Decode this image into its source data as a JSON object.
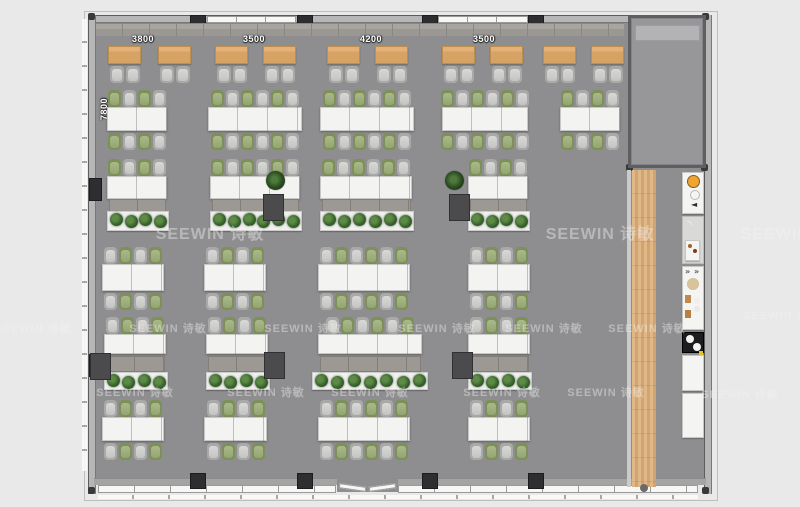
{
  "meta": {
    "description_label": "office floor plan rendering"
  },
  "watermark": {
    "text": "SEEWIN 诗敏",
    "large": [
      [
        210,
        232
      ],
      [
        600,
        232
      ],
      [
        795,
        232
      ]
    ],
    "small": [
      [
        33,
        328
      ],
      [
        168,
        328
      ],
      [
        303,
        328
      ],
      [
        437,
        328
      ],
      [
        544,
        328
      ],
      [
        647,
        328
      ],
      [
        782,
        315
      ],
      [
        135,
        392
      ],
      [
        266,
        392
      ],
      [
        370,
        392
      ],
      [
        502,
        392
      ],
      [
        606,
        392
      ],
      [
        740,
        394
      ]
    ]
  },
  "dimensions": {
    "top_y": 34,
    "top": [
      {
        "text": "3800",
        "x": 142
      },
      {
        "text": "3500",
        "x": 253
      },
      {
        "text": "4200",
        "x": 370
      },
      {
        "text": "3500",
        "x": 483
      }
    ],
    "side": {
      "text": "7800",
      "x": 104,
      "y": 113
    }
  },
  "colors": {
    "background": "#e9e9e9",
    "floor": "#8e8e90",
    "wall": "#b6b6b6",
    "column": "#2e2e31",
    "desk_wood": "#d9a96b",
    "desk_white": "#f3f3f1",
    "chair_gray": "#c8c8c6",
    "chair_green": "#93a471",
    "plant_green": "#35602a",
    "walkway_wood": "#d9ab74",
    "counter_white": "#f4f4f2",
    "appliance_orange": "#e08a1e",
    "appliance_black": "#1d1d1f",
    "watermark": "#f4f4f4"
  },
  "plan": {
    "shell": {
      "x": 90,
      "y": 15,
      "w": 620,
      "h": 479,
      "wall": 8
    },
    "columns_top_x": [
      190,
      297,
      422,
      528
    ],
    "columns_bottom_x": [
      190,
      297,
      422,
      528
    ],
    "windows_top": [
      [
        207,
        296
      ],
      [
        438,
        528
      ],
      [
        640,
        702
      ]
    ],
    "windows_bottom": [
      [
        98,
        336
      ],
      [
        398,
        698
      ]
    ],
    "door_bottom": {
      "x": 337,
      "w": 61
    },
    "left_wall_columns_y": [
      178,
      354
    ],
    "top_cabinets": {
      "x": 96,
      "y": 23,
      "w": 528,
      "h": 13
    },
    "r1": {
      "desk_y": 46,
      "desk_h": 18,
      "desk_w": 33,
      "chair_y": 66,
      "desks_x": [
        108,
        158,
        215,
        263,
        327,
        375,
        442,
        490,
        543,
        591
      ]
    },
    "bench_rows": [
      {
        "chair_top_y": 90,
        "desk_y": 107,
        "desk_h": 24,
        "chair_bot_y": 133,
        "start": "green",
        "clusters": [
          {
            "x": 107,
            "w": 60,
            "n": 4
          },
          {
            "x": 208,
            "w": 94,
            "n": 6
          },
          {
            "x": 320,
            "w": 94,
            "n": 6
          },
          {
            "x": 442,
            "w": 86,
            "n": 6
          },
          {
            "x": 560,
            "w": 60,
            "n": 4
          }
        ]
      },
      {
        "chair_top_y": 247,
        "desk_y": 264,
        "desk_h": 27,
        "chair_bot_y": 293,
        "start": "gray",
        "clusters": [
          {
            "x": 102,
            "w": 62,
            "n": 4
          },
          {
            "x": 204,
            "w": 62,
            "n": 4
          },
          {
            "x": 318,
            "w": 92,
            "n": 6
          },
          {
            "x": 468,
            "w": 62,
            "n": 4
          }
        ]
      },
      {
        "chair_top_y": 400,
        "desk_y": 417,
        "desk_h": 24,
        "chair_bot_y": 443,
        "start": "gray",
        "clusters": [
          {
            "x": 102,
            "w": 62,
            "n": 4
          },
          {
            "x": 204,
            "w": 63,
            "n": 4
          },
          {
            "x": 318,
            "w": 92,
            "n": 6
          },
          {
            "x": 468,
            "w": 62,
            "n": 4
          }
        ]
      }
    ],
    "storage_rows": [
      {
        "chair_y": 159,
        "desk_y": 176,
        "desk_h": 23,
        "cab_y": 199,
        "cab_h": 15,
        "pl_y": 211,
        "pl_h": 20,
        "start": "green",
        "clusters": [
          {
            "x": 107,
            "w": 60,
            "n": 4
          },
          {
            "x": 210,
            "w": 90,
            "n": 6
          },
          {
            "x": 320,
            "w": 92,
            "n": 6
          },
          {
            "x": 468,
            "w": 60,
            "n": 4
          }
        ],
        "squares": [
          [
            263,
            194
          ],
          [
            449,
            194
          ]
        ],
        "plants": [
          [
            276,
            181
          ],
          [
            455,
            181
          ]
        ]
      },
      {
        "chair_y": 317,
        "desk_y": 334,
        "desk_h": 20,
        "cab_y": 356,
        "cab_h": 16,
        "pl_y": 372,
        "pl_h": 18,
        "start": "gray",
        "clusters": [
          {
            "x": 104,
            "w": 62,
            "n": 4
          },
          {
            "x": 206,
            "w": 62,
            "n": 4
          },
          {
            "x": 318,
            "w": 104,
            "n": 6,
            "pl_x": 312,
            "pl_w": 116
          },
          {
            "x": 468,
            "w": 62,
            "n": 4
          }
        ],
        "squares": [
          [
            90,
            353
          ],
          [
            264,
            352
          ],
          [
            452,
            352
          ]
        ],
        "plants": []
      }
    ],
    "room": {
      "x": 628,
      "y": 15,
      "w": 78,
      "h": 153,
      "sill_y": 25,
      "sill_h": 16
    },
    "walkway": {
      "x": 632,
      "y": 170,
      "w": 24,
      "h": 317
    },
    "kitchen": {
      "x": 682,
      "w": 22,
      "units": [
        {
          "y": 172,
          "h": 42,
          "type": "stove"
        },
        {
          "y": 216,
          "h": 48,
          "type": "coffee"
        },
        {
          "y": 266,
          "h": 64,
          "type": "sink"
        },
        {
          "y": 332,
          "h": 21,
          "type": "cooktop"
        },
        {
          "y": 355,
          "h": 36,
          "type": "counter"
        },
        {
          "y": 393,
          "h": 45,
          "type": "counter"
        }
      ]
    }
  }
}
